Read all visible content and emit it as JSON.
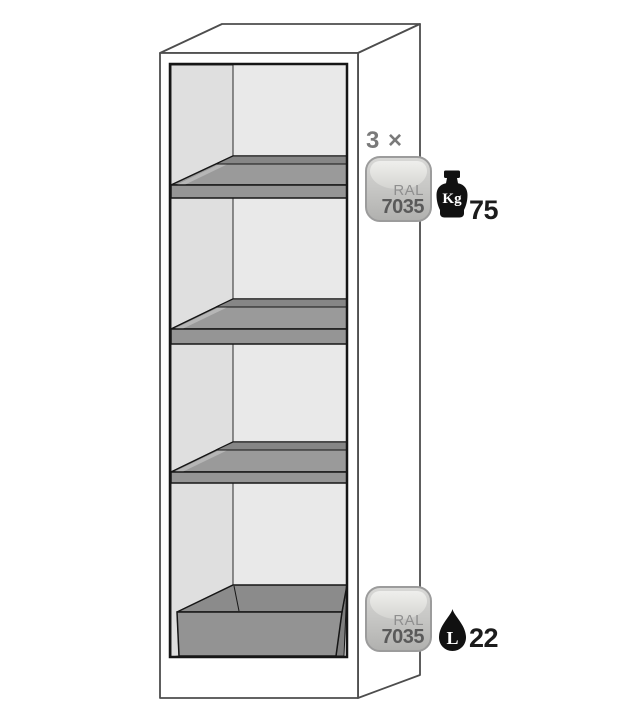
{
  "diagram": {
    "shelves": {
      "count_label": "3 ×",
      "color_badge": {
        "prefix": "RAL",
        "code": "7035"
      },
      "load": {
        "unit": "Kg",
        "value": "75"
      }
    },
    "sump": {
      "color_badge": {
        "prefix": "RAL",
        "code": "7035"
      },
      "volume": {
        "unit": "L",
        "value": "22"
      }
    },
    "colors": {
      "outline_gray": "#4d4d4d",
      "frame_black": "#161616",
      "wall_left": "#dfdfdf",
      "wall_back": "#e9e9e9",
      "shelf_surface": "#9a9a9a",
      "shelf_riser": "#868686",
      "shelf_front_band": "#959595",
      "shelf_lip_highlight": "#b6b6b6",
      "sump_surface": "#8b8b8b",
      "sump_front": "#939393",
      "badge_border": "#9c9c9c",
      "label_gray": "#7a7a7a",
      "icon_black": "#111111"
    }
  }
}
